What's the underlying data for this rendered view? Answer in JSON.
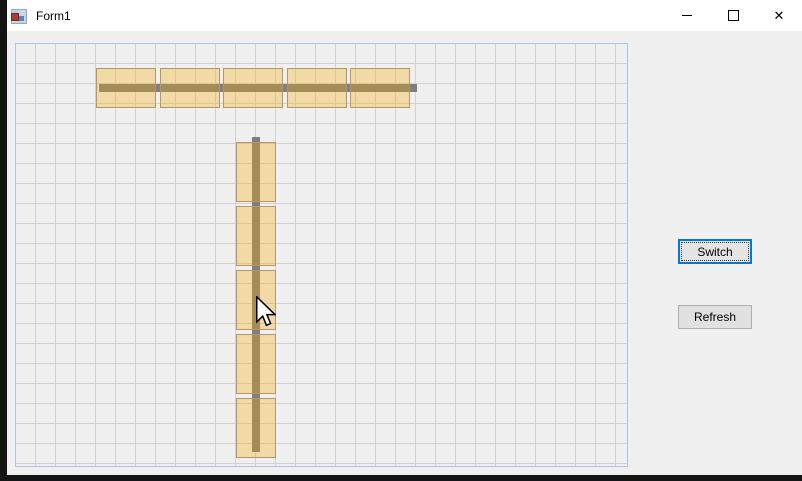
{
  "window": {
    "title": "Form1",
    "controls": {
      "close_glyph": "✕"
    }
  },
  "side_buttons": {
    "switch_label": "Switch",
    "refresh_label": "Refresh"
  },
  "colors": {
    "accent_focus_blue": "#0078d7",
    "tile_fill": "rgba(246,170,3,0.31)",
    "tile_border": "#b2976b",
    "stick_gray": "#7f7f7f",
    "panel_border_blue": "#a9c7e9",
    "grid_line": "#d2d2d2",
    "form_background": "#f0f0f0",
    "titlebar_background": "#ffffff"
  },
  "board": {
    "grid_cell_px": 20,
    "sticks": [
      {
        "name": "horizontal-stick",
        "x": 83,
        "y": 40,
        "w": 318,
        "h": 8
      },
      {
        "name": "vertical-stick",
        "x": 236,
        "y": 93,
        "w": 8,
        "h": 315
      }
    ],
    "tiles": [
      {
        "name": "h-tile-1",
        "x": 80,
        "y": 24,
        "w": 60,
        "h": 40
      },
      {
        "name": "h-tile-2",
        "x": 144,
        "y": 24,
        "w": 60,
        "h": 40
      },
      {
        "name": "h-tile-3",
        "x": 207,
        "y": 24,
        "w": 60,
        "h": 40
      },
      {
        "name": "h-tile-4",
        "x": 271,
        "y": 24,
        "w": 60,
        "h": 40
      },
      {
        "name": "h-tile-5",
        "x": 334,
        "y": 24,
        "w": 60,
        "h": 40
      },
      {
        "name": "v-tile-1",
        "x": 220,
        "y": 98,
        "w": 40,
        "h": 60
      },
      {
        "name": "v-tile-2",
        "x": 220,
        "y": 162,
        "w": 40,
        "h": 60
      },
      {
        "name": "v-tile-3",
        "x": 220,
        "y": 226,
        "w": 40,
        "h": 60
      },
      {
        "name": "v-tile-4",
        "x": 220,
        "y": 290,
        "w": 40,
        "h": 60
      },
      {
        "name": "v-tile-5",
        "x": 220,
        "y": 354,
        "w": 40,
        "h": 60
      }
    ]
  },
  "cursor": {
    "x": 255,
    "y": 296
  }
}
